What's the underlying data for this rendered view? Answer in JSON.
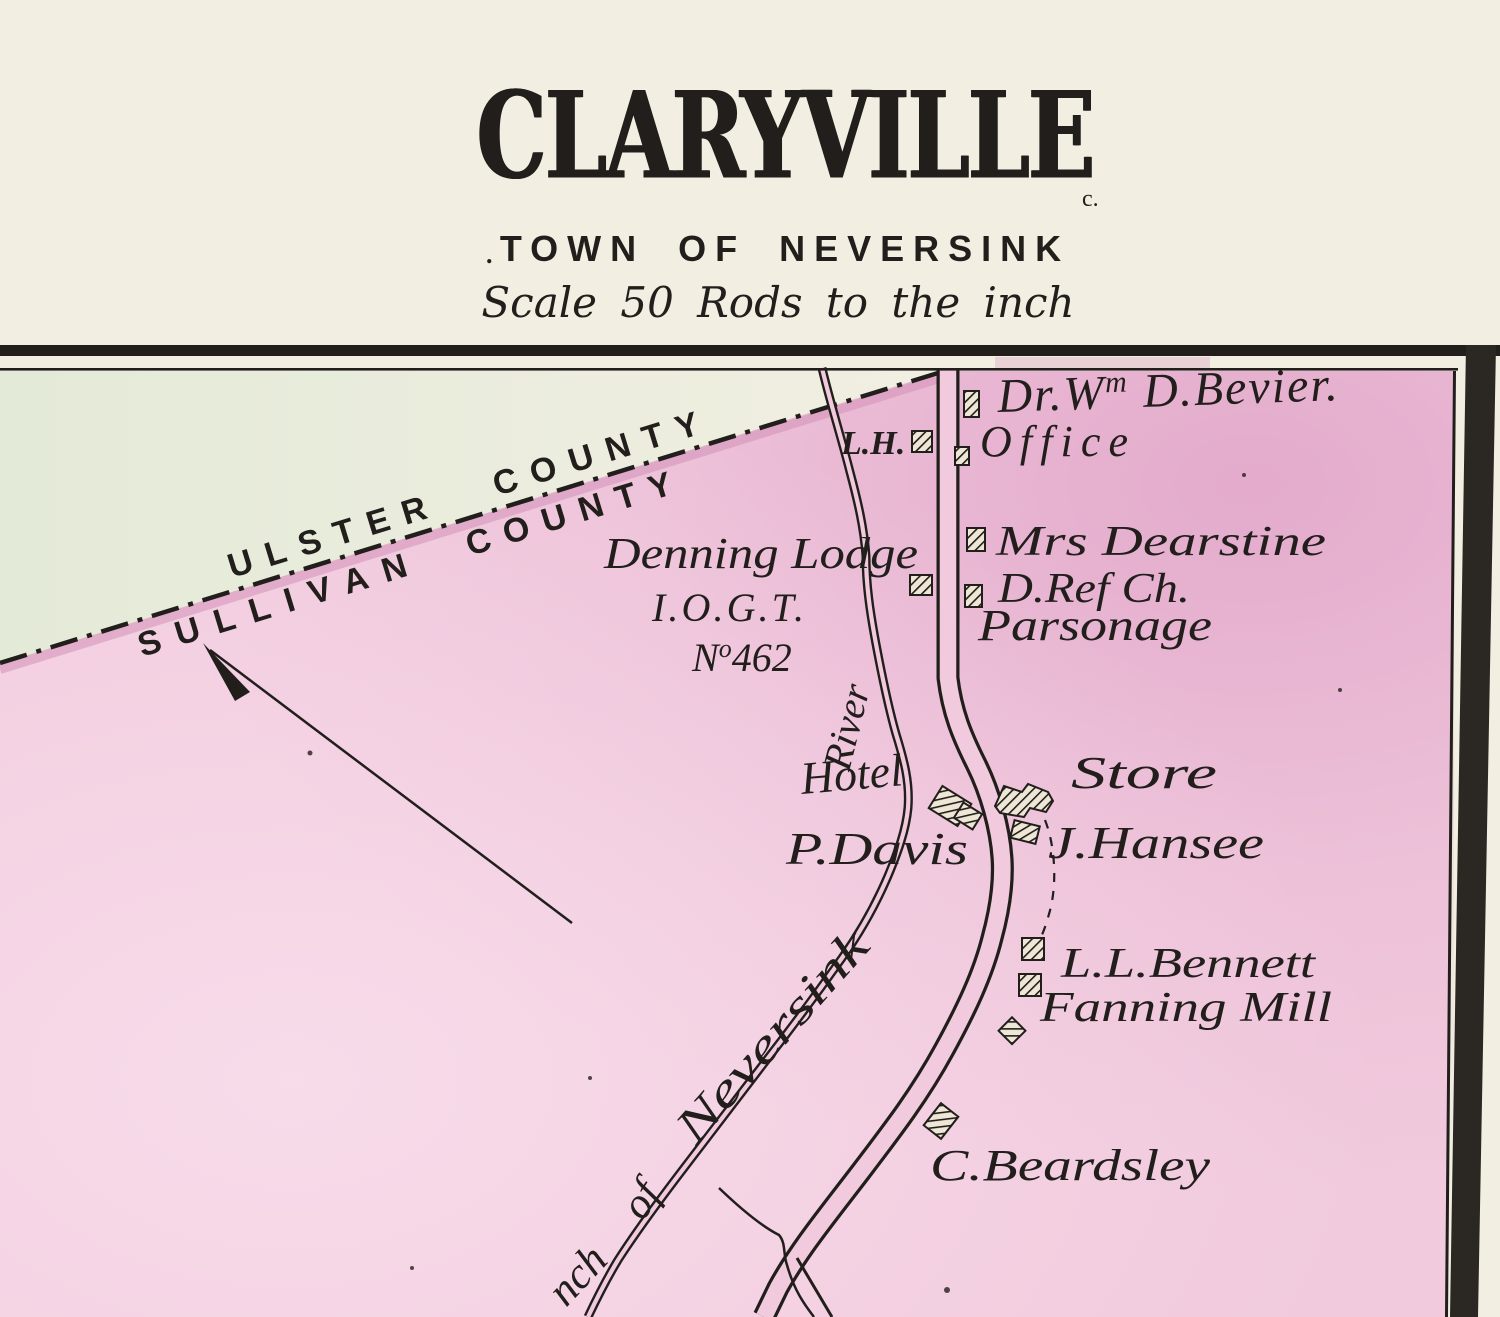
{
  "colors": {
    "paper": "#f2efe2",
    "map_pink": "#f1cadd",
    "pink_deep": "#dda0c6",
    "pink_light": "#f8ddeb",
    "ulster_green": "#e6ecdb",
    "ink": "#211e1c",
    "boundary_pink": "#d48fb8",
    "band": "#2b2723"
  },
  "header": {
    "title": "CLARYVILLE",
    "subtitle": "TOWN OF NEVERSINK",
    "scale_note": "Scale 50 Rods to the inch",
    "mark_left": ".",
    "mark_right": "c."
  },
  "map": {
    "counties": {
      "ulster": "ULSTER",
      "ulster_county": "COUNTY",
      "sullivan": "SULLIVAN",
      "sullivan_county": "COUNTY"
    },
    "water": {
      "river_label": "River",
      "branch_seg1": "nch",
      "branch_seg2": "of",
      "branch_seg3": "Neversink"
    },
    "labels": {
      "bevier_pre": "Dr.W",
      "bevier_sup": "m",
      "bevier_post": " D.Bevier.",
      "office": "Office",
      "lh": "L.H.",
      "dearstine": "Mrs Dearstine",
      "dref_ch": "D.Ref Ch.",
      "parsonage": "Parsonage",
      "denning_line1": "Denning Lodge",
      "denning_line2": "I.O.G.T.",
      "lodge_no_n": "N",
      "lodge_no_sup": "o",
      "lodge_no_num": "462",
      "hotel": "Hotel",
      "davis": "P.Davis",
      "store": "Store",
      "hansee": "J.Hansee",
      "bennett": "L.L.Bennett",
      "fanning_mill": "Fanning Mill",
      "beardsley": "C.Beardsley"
    }
  }
}
